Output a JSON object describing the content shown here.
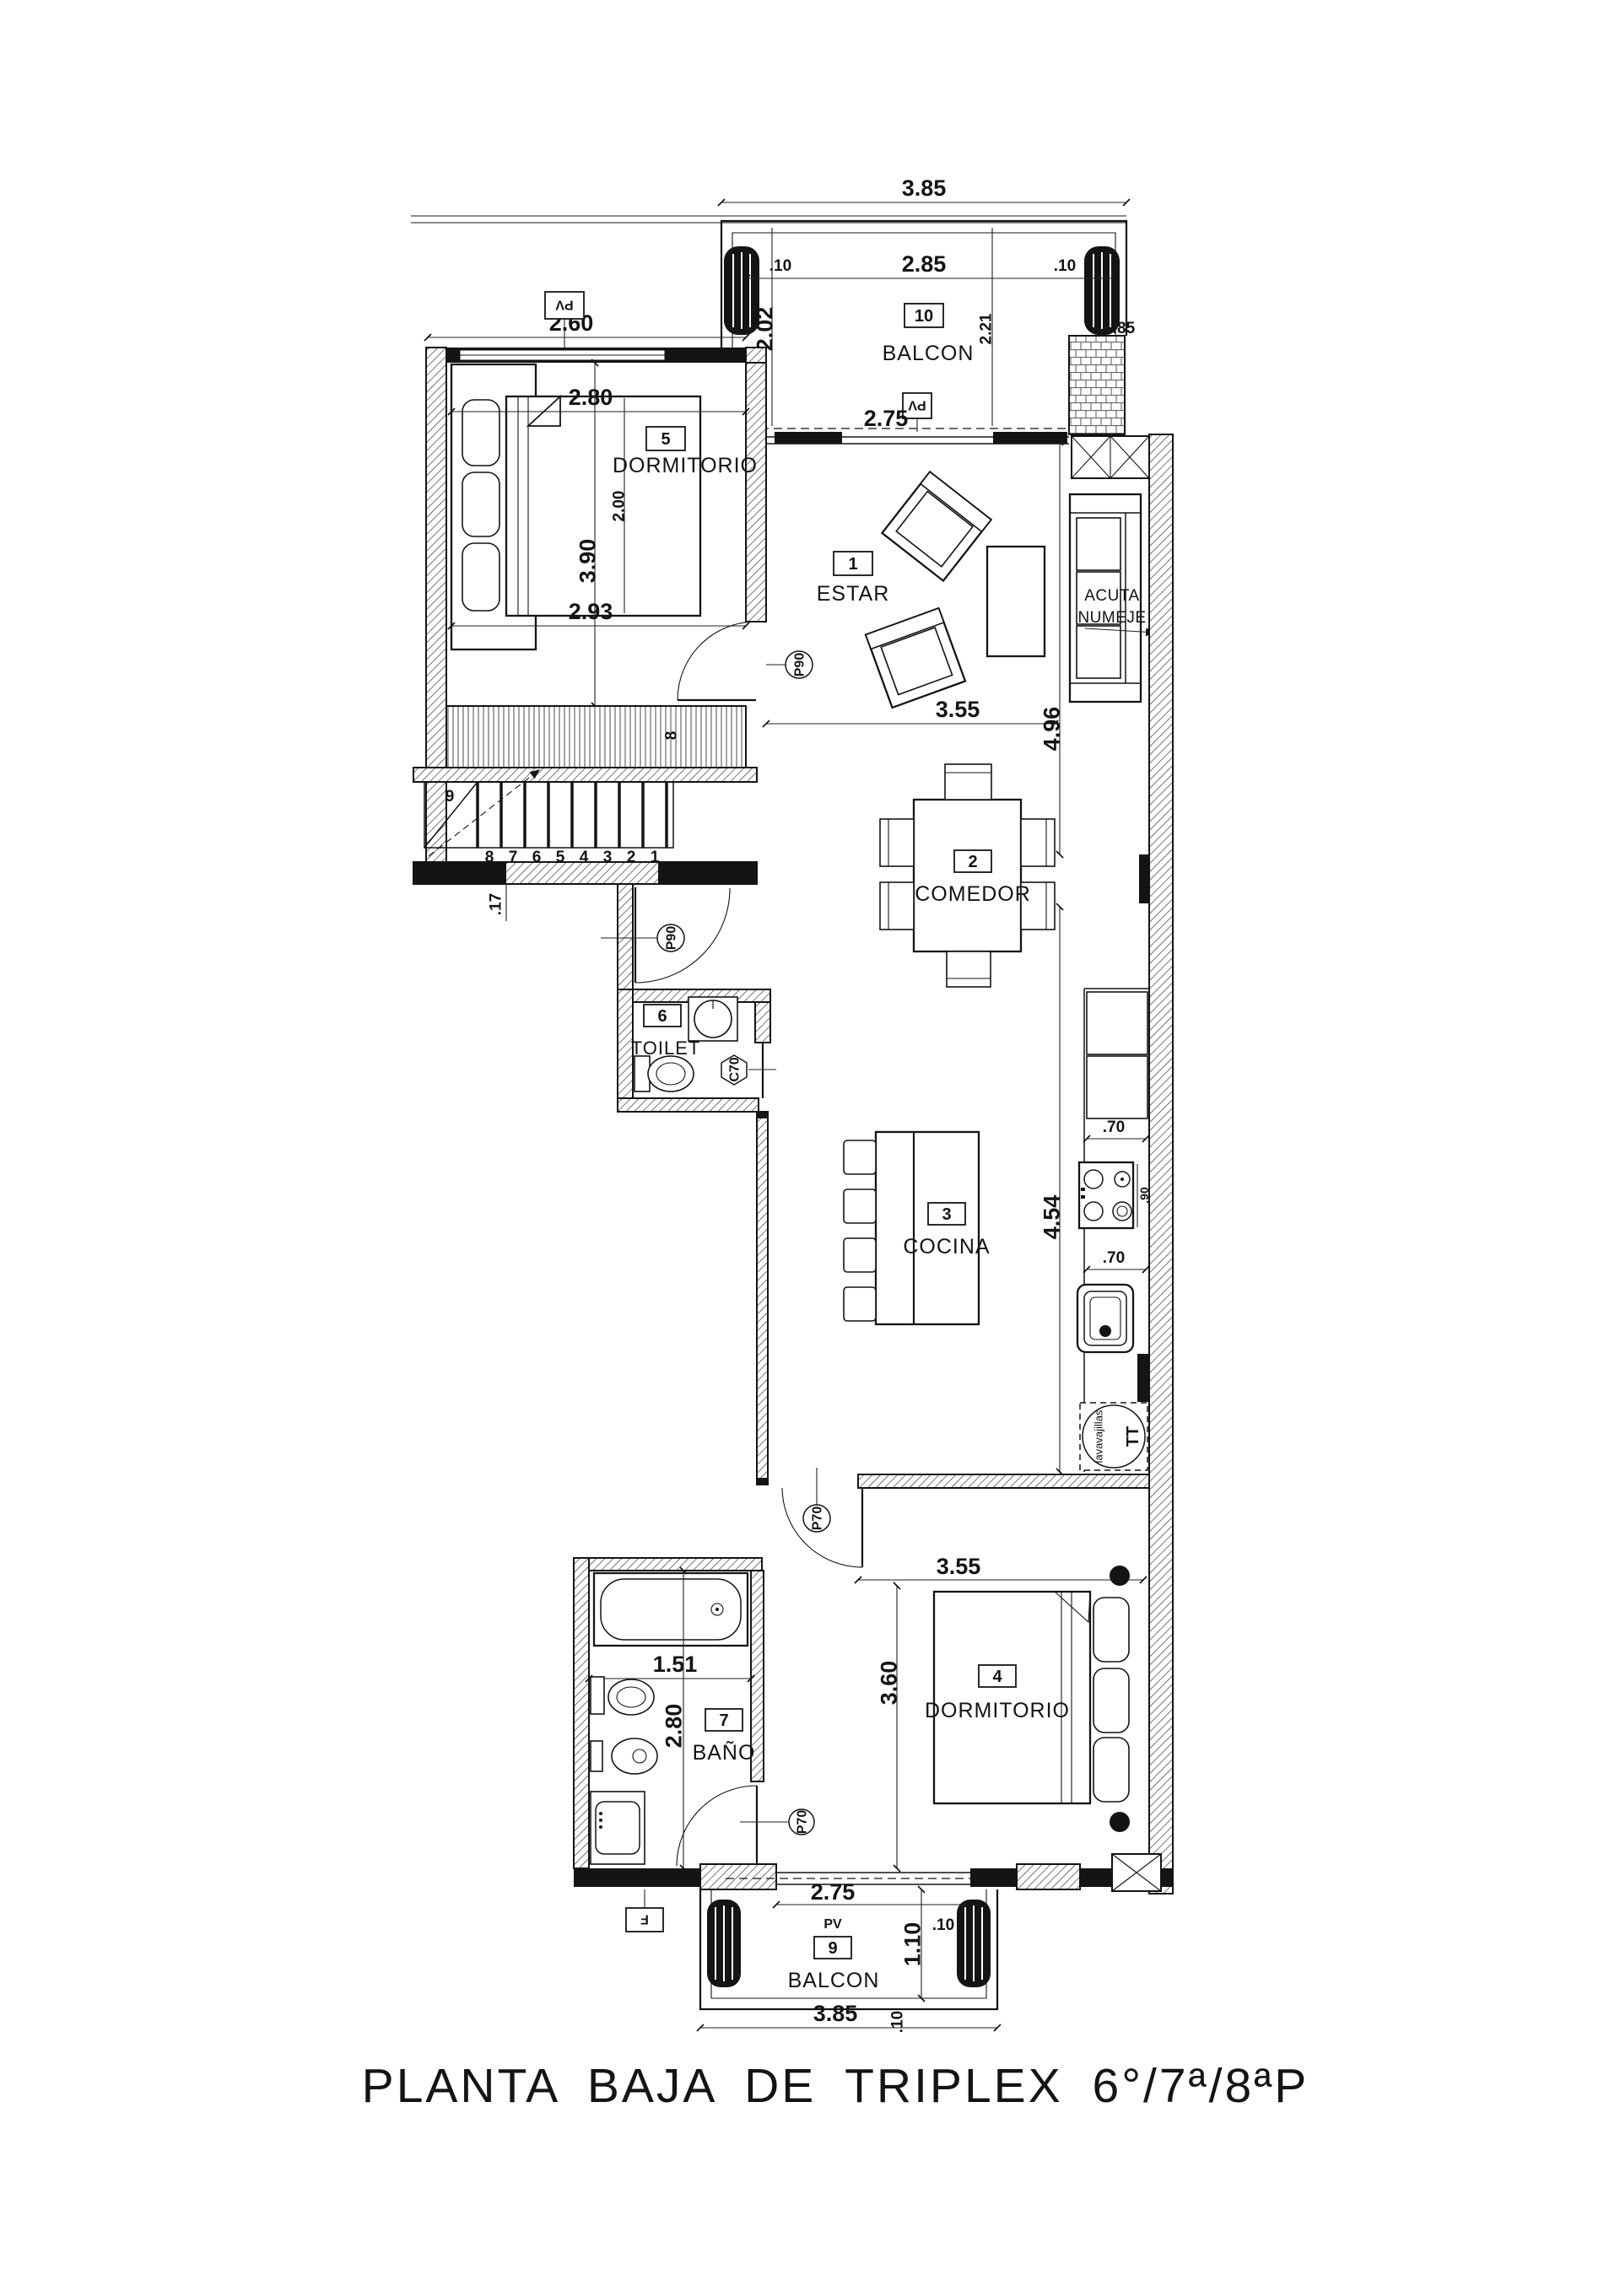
{
  "title": "PLANTA BAJA DE TRIPLEX 6°/7ª/8ªP",
  "colors": {
    "ink": "#141414",
    "paper": "#ffffff"
  },
  "rooms": {
    "estar": {
      "number": "1",
      "name": "ESTAR"
    },
    "comedor": {
      "number": "2",
      "name": "COMEDOR"
    },
    "cocina": {
      "number": "3",
      "name": "COCINA"
    },
    "dormitorio_4": {
      "number": "4",
      "name": "DORMITORIO"
    },
    "dormitorio_5": {
      "number": "5",
      "name": "DORMITORIO"
    },
    "toilet": {
      "number": "6",
      "name": "TOILET"
    },
    "bano": {
      "number": "7",
      "name": "BAÑO"
    },
    "placard": {
      "number": "8"
    },
    "balcon_9": {
      "number": "9",
      "name": "BALCON"
    },
    "balcon_10": {
      "number": "10",
      "name": "BALCON"
    }
  },
  "doors": {
    "pv": "PV",
    "p90": "P90",
    "p70": "P70",
    "c70": "C70",
    "f": "F"
  },
  "stairs": {
    "landing_step": "9",
    "steps": [
      "8",
      "7",
      "6",
      "5",
      "4",
      "3",
      "2",
      "1"
    ],
    "riser_dim": ".17"
  },
  "dims": {
    "balcon10_total": "3.85",
    "balcon10_inner": "2.85",
    "parapet_left": ".10",
    "parapet_right": ".10",
    "balcon10_depth_left": "2.02",
    "balcon10_depth_mid": "2.21",
    "pillar": ".85",
    "balcon10_door": "2.75",
    "dorm5_top": "2.60",
    "dorm5_bed": "2.80",
    "dorm5_bed_len": "2.00",
    "dorm5_depth": "3.90",
    "dorm5_bottom": "2.93",
    "estar_width": "3.55",
    "estar_depth": "4.96",
    "cocina_depth": "4.54",
    "counter_top": ".70",
    "counter_bottom": ".70",
    "cooktop": ".90",
    "dorm4_width": "3.55",
    "dorm4_depth": "3.60",
    "bano_width": "1.51",
    "bano_depth": "2.80",
    "balcon9_door": "2.75",
    "balcon9_depth": "1.10",
    "balcon9_parapet": ".10",
    "balcon9_offset": ".10",
    "balcon9_total": "3.85"
  },
  "annotations": {
    "acota_line1": "ACUTA",
    "acota_line2": "NUMEJE",
    "dishwasher": "lavavajillas",
    "dishwasher_code": "TT"
  }
}
